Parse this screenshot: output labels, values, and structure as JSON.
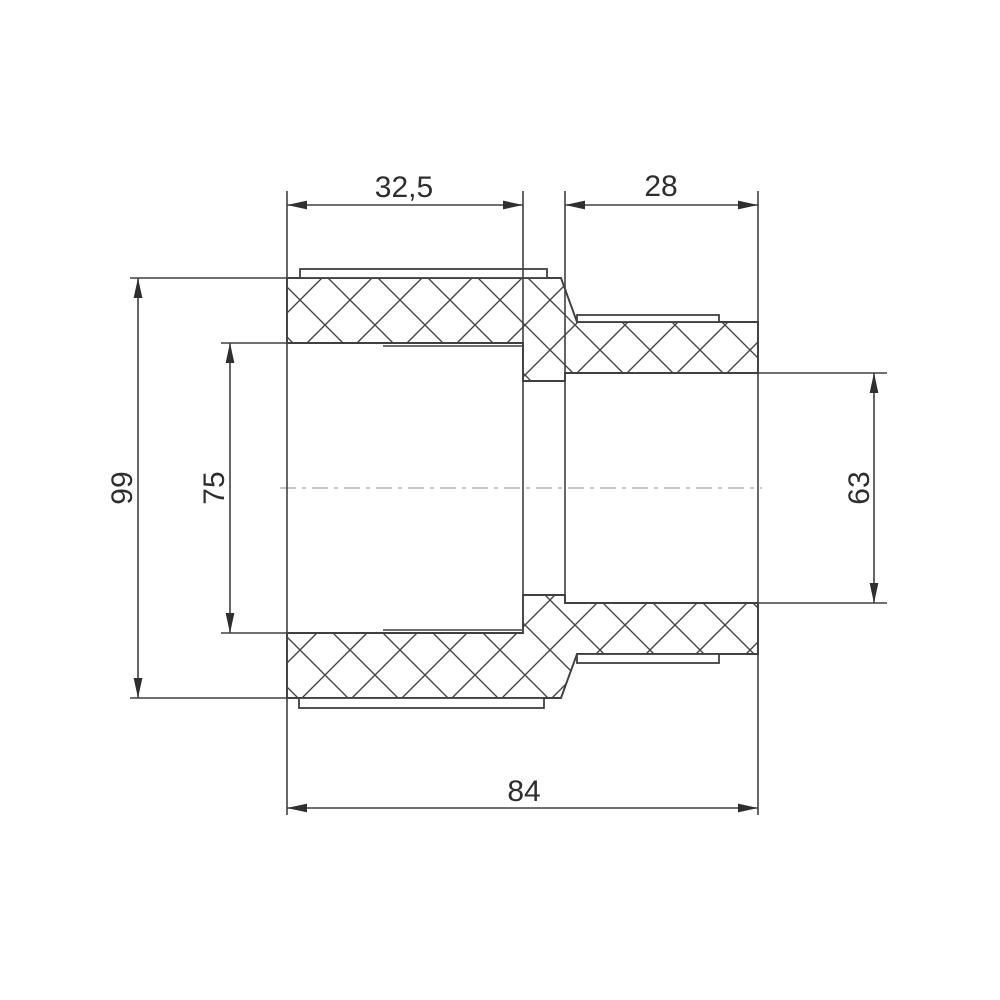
{
  "drawing": {
    "kind": "technical-drawing-cross-section",
    "dimensions": {
      "socket_left_depth": "32,5",
      "socket_right_depth": "28",
      "outer_diameter_left": "99",
      "bore_left": "75",
      "bore_right": "63",
      "overall_length": "84"
    },
    "colors": {
      "background": "#ffffff",
      "line": "#404040",
      "text": "#2e2e2e",
      "centerline": "#b4b4b4"
    }
  }
}
